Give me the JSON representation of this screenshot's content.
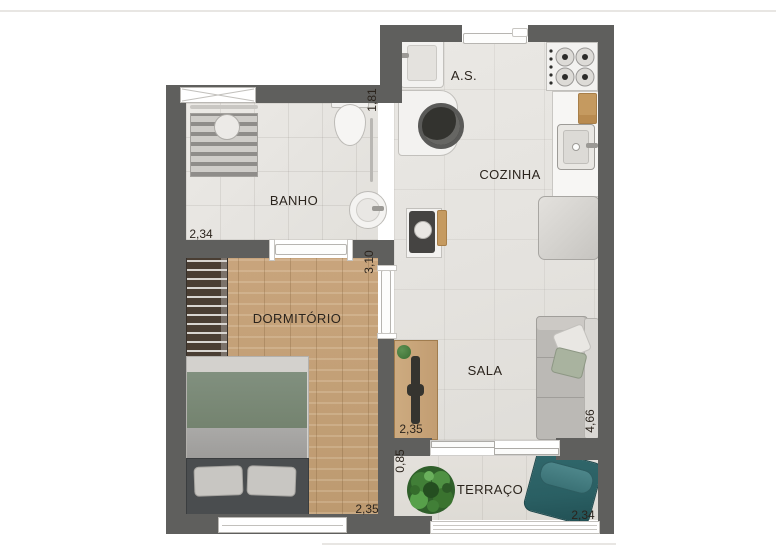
{
  "floorplan": {
    "type": "apartment-floor-plan",
    "wall_color": "#5f5f5d",
    "background": "#ffffff",
    "label_color": "#2b241d",
    "rooms": {
      "banho": {
        "label": "BANHO",
        "dim_width": "2,34",
        "dim_depth": "1,81"
      },
      "area_servico": {
        "label": "A.S."
      },
      "cozinha": {
        "label": "COZINHA"
      },
      "dormitorio": {
        "label": "DORMITÓRIO",
        "dim_depth": "3,10",
        "dim_width": "2,35"
      },
      "sala": {
        "label": "SALA",
        "dim_depth": "4,66",
        "dim_width": "2,35"
      },
      "terraco": {
        "label": "TERRAÇO",
        "dim_depth": "0,85",
        "dim_width": "2,34"
      }
    },
    "floors": {
      "wet_area_tile": "#e8e6e2",
      "bedroom_wood": "#c3a077",
      "terrace_tile": "#e0ddd8"
    },
    "furniture_colors": {
      "bed_duvet_green": "#7b897b",
      "lounge_chair_teal": "#2c6468",
      "plant_green": "#3f7a38",
      "wood_furniture": "#c9a97e"
    },
    "fixtures": [
      "window-icon",
      "entry-door-icon",
      "interior-door-icon",
      "sliding-door-icon",
      "shower-icon",
      "toilet-icon",
      "pedestal-sink-icon",
      "laundry-tank-icon",
      "washing-machine-icon",
      "stove-icon",
      "kitchen-sink-icon",
      "fridge-icon",
      "service-table-icon",
      "wardrobe-icon",
      "double-bed-icon",
      "tv-rack-icon",
      "sofa-icon",
      "potted-plant-icon",
      "lounge-chair-icon",
      "glass-railing-icon"
    ]
  }
}
